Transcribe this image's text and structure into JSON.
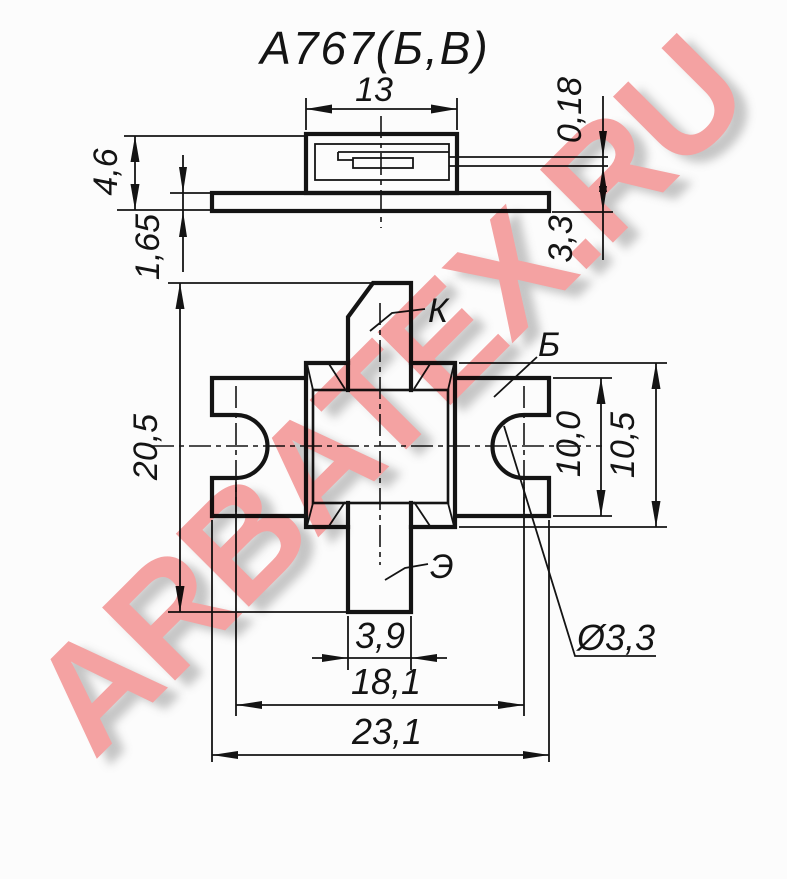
{
  "title": "А767(Б,В)",
  "watermark": {
    "text": "ARBATEX.RU",
    "color": "#f7a4a4"
  },
  "colors": {
    "line": "#141414",
    "background": "#fcfcfc"
  },
  "side_view": {
    "dim_cap_width": "13",
    "dim_total_height": "4,6",
    "dim_flange_thickness": "1,65",
    "dim_lead_thickness": "0,18",
    "dim_lead_offset": "3,3"
  },
  "plan_view": {
    "dim_total_length": "20,5",
    "dim_body_width": "10,0",
    "dim_flange_width": "10,5",
    "dim_emitter_lead_width": "3,9",
    "dim_hole_spacing": "18,1",
    "dim_total_width": "23,1",
    "dim_hole_diameter": "Ø3,3",
    "lead_collector": "К",
    "lead_base": "Б",
    "lead_emitter": "Э"
  }
}
